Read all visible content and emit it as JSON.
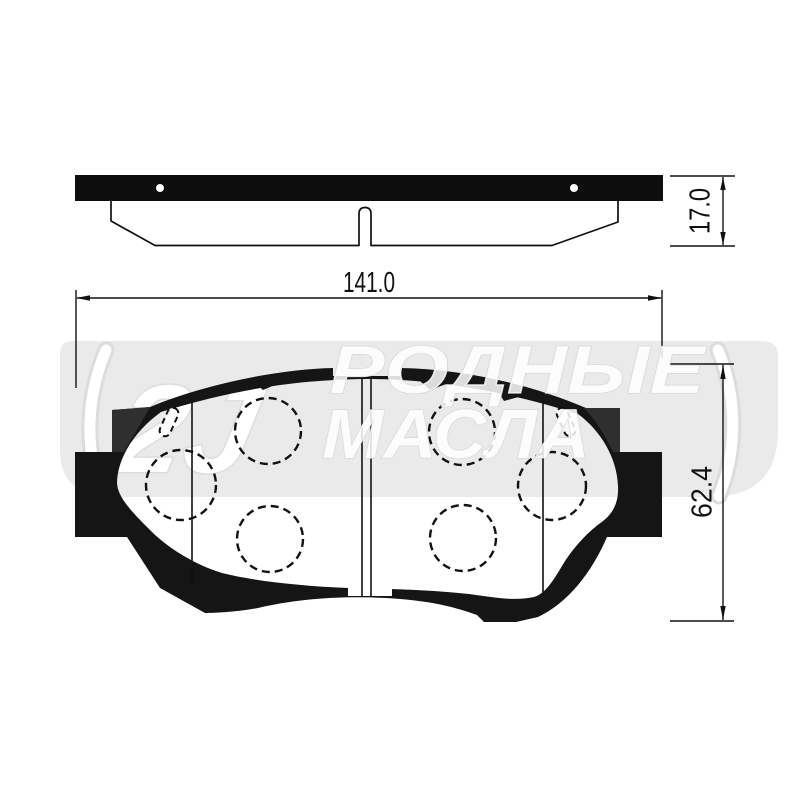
{
  "document": {
    "kind": "technical drawing of a disc brake pad set, two orthographic views",
    "views": {
      "side_view": "top strip view: backing plate with two rivet holes and friction profile",
      "front_view": "main view: pad silhouette with wear slots, guide circles and center groove"
    }
  },
  "dimensions": {
    "width_label": "141.0",
    "height_label": "62.4",
    "thickness_label": "17.0"
  },
  "watermark": {
    "line1": "РОДНЫЕ",
    "line2": "МАСЛА",
    "logo_mark": "2J"
  },
  "colors": {
    "ink": "#111111",
    "paper": "#ffffff",
    "watermark_band": "#eaeaea",
    "watermark_letter": "#ffffff",
    "shim_shade": "#2f2f2f"
  }
}
